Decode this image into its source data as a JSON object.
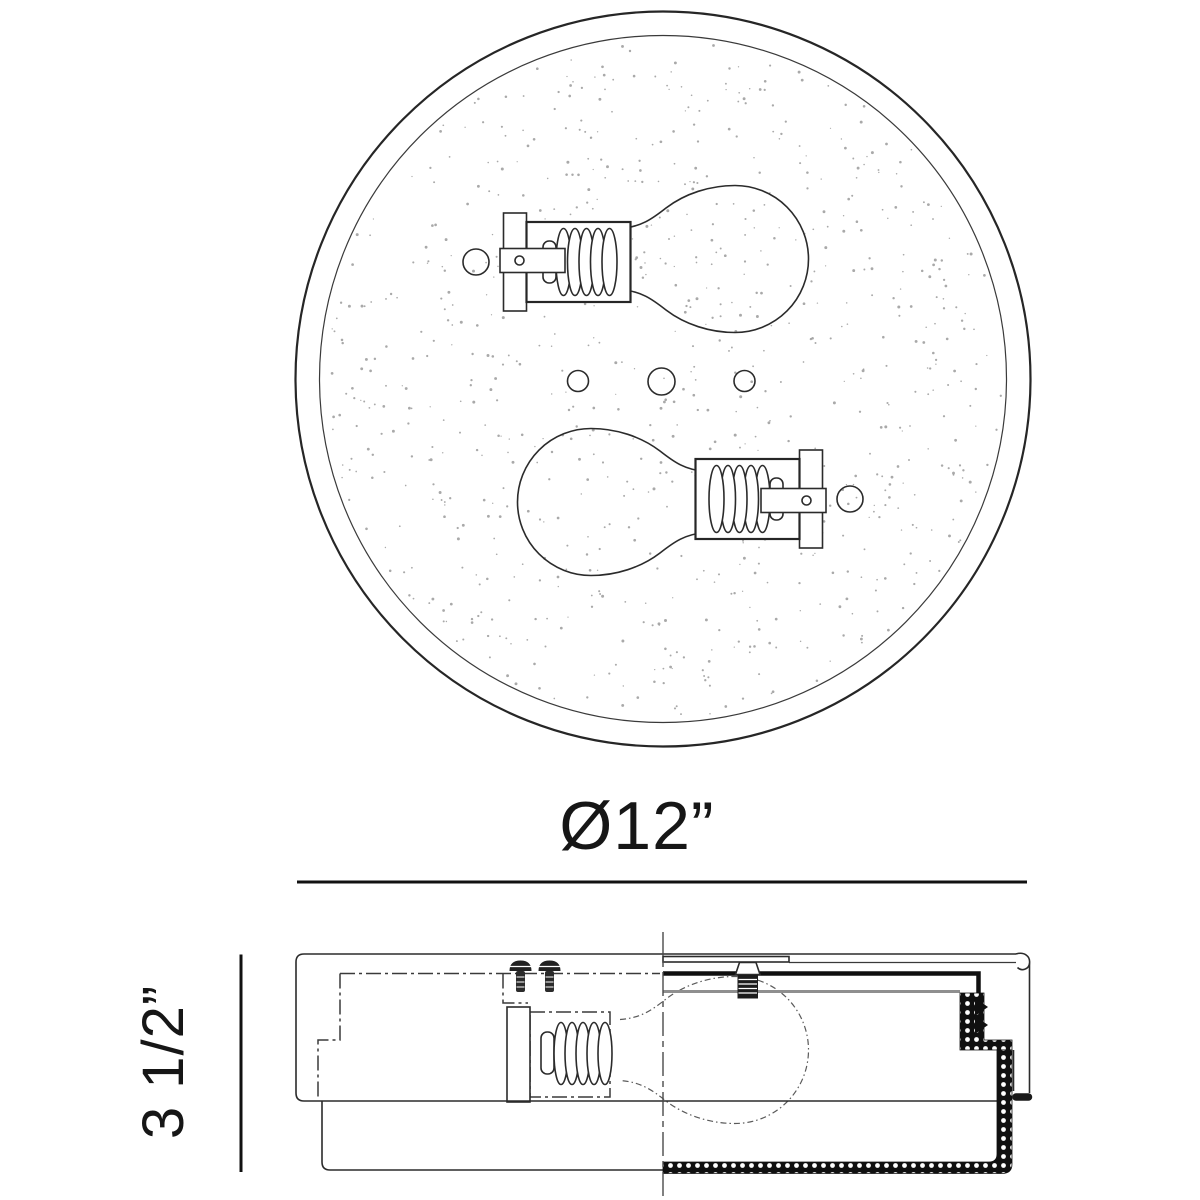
{
  "drawing": {
    "top_view_diameter_label": "Ø12”",
    "side_view_height_label": "3 1/2”"
  },
  "colors": {
    "line": "#2b2b2b",
    "dimension": "#111111",
    "hidden_line": "#3a3a3a",
    "soft_line": "#8f8f8f",
    "stipple": "#9a9a9a",
    "background": "#ffffff"
  },
  "parts": {
    "top_view": [
      "outer-rim",
      "glass-diffuser",
      "bulb-left-facing-right",
      "bulb-right-facing-left",
      "socket",
      "socket-bracket",
      "mounting-hole",
      "center-wire-holes"
    ],
    "side_view": [
      "canopy",
      "mounting-plate",
      "threaded-nipple",
      "hex-nut",
      "mounting-screws",
      "socket",
      "bulb",
      "glass-shade-section",
      "trim-channel",
      "centerline"
    ]
  }
}
